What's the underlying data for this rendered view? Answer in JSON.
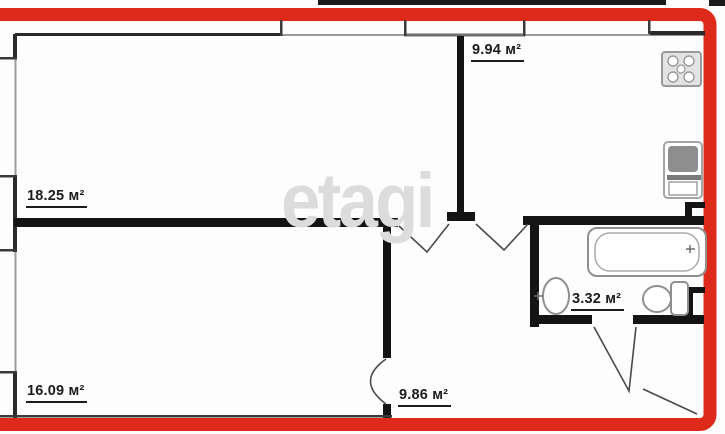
{
  "plan": {
    "watermark": "etagi",
    "rooms": {
      "living": {
        "label": "18.25 м²"
      },
      "kitchen": {
        "label": "9.94 м²"
      },
      "bedroom": {
        "label": "16.09 м²"
      },
      "hallway": {
        "label": "9.86 м²"
      },
      "bathroom": {
        "label": "3.32 м²"
      }
    },
    "colors": {
      "border_red": "#dd2a1b",
      "wall_black": "#141414",
      "window_gray": "#9a9a9a",
      "fixture_gray": "#8f8f8f",
      "label_dark": "#1c1c1c",
      "watermark_gray": "#dcdcdc"
    }
  }
}
